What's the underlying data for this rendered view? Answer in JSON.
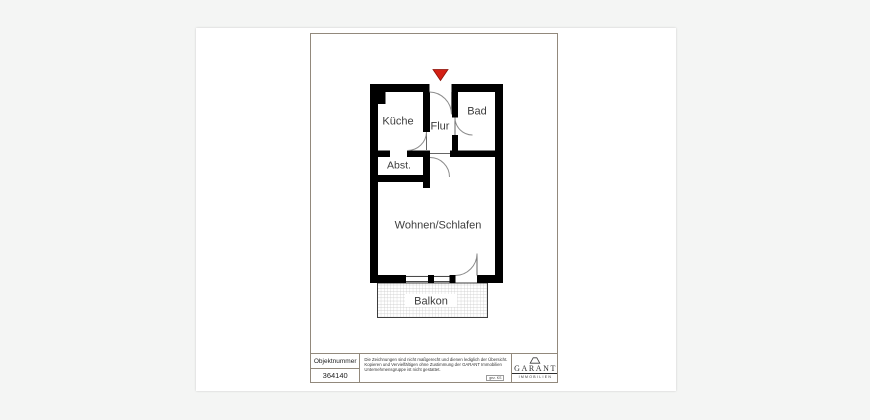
{
  "colors": {
    "background": "#f4f5f4",
    "paper": "#ffffff",
    "wall": "#000000",
    "door_arc": "#8c8c8c",
    "entrance_marker": "#d42015",
    "frame_border": "#92897c",
    "hatch_line": "#c4c4c4"
  },
  "floorplan": {
    "rooms": [
      {
        "id": "kueche",
        "label": "Küche"
      },
      {
        "id": "flur",
        "label": "Flur"
      },
      {
        "id": "bad",
        "label": "Bad"
      },
      {
        "id": "abstellraum",
        "label": "Abst."
      },
      {
        "id": "wohnen_schlafen",
        "label": "Wohnen/Schlafen"
      },
      {
        "id": "balkon",
        "label": "Balkon"
      }
    ]
  },
  "title_block": {
    "object_number_label": "Objektnummer",
    "object_number_value": "364140",
    "disclaimer_lines": [
      "Die Zeichnungen sind nicht maßgerecht und dienen lediglich der Übersicht.",
      "Kopieren und Vervielfältigen ohne Zustimmung der GARANT Immobilien",
      "Unternehmensgruppe ist nicht gestattet."
    ],
    "drawn_by": "gez. KS",
    "logo_name": "GARANT",
    "logo_subtitle": "IMMOBILIEN"
  }
}
